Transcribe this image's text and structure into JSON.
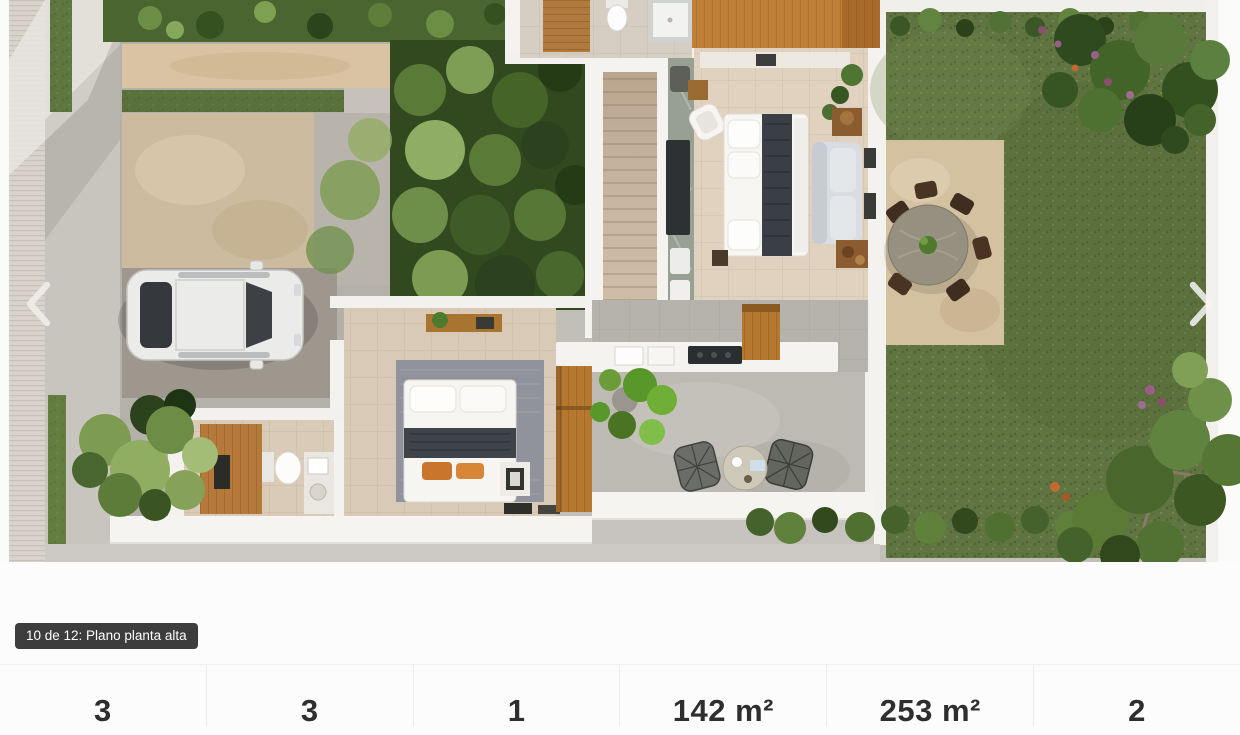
{
  "gallery": {
    "caption": "10 de 12: Plano planta alta",
    "current_index": "10",
    "total_images": "12",
    "image_title": "Plano planta alta",
    "image_description": "Render aéreo 3D de la planta alta: cochera con auto blanco, escalera, dos recámaras, baños, terraza y jardín con comedor exterior",
    "icons": {
      "prev": "chevron-left",
      "next": "chevron-right"
    }
  },
  "stats": {
    "items": [
      {
        "value": "3"
      },
      {
        "value": "3"
      },
      {
        "value": "1"
      },
      {
        "value": "142 m²"
      },
      {
        "value": "253 m²"
      },
      {
        "value": "2"
      }
    ]
  },
  "colors": {
    "page_bg": "#fcfcfc",
    "badge_bg": "#3d3d3d",
    "badge_text": "#ffffff",
    "divider": "#ededed",
    "stat_text": "#2e2e2e",
    "lawn_green": "#5f7440",
    "patio_beige": "#cfbc9d",
    "nav_arrow": "#f2f0ec"
  }
}
